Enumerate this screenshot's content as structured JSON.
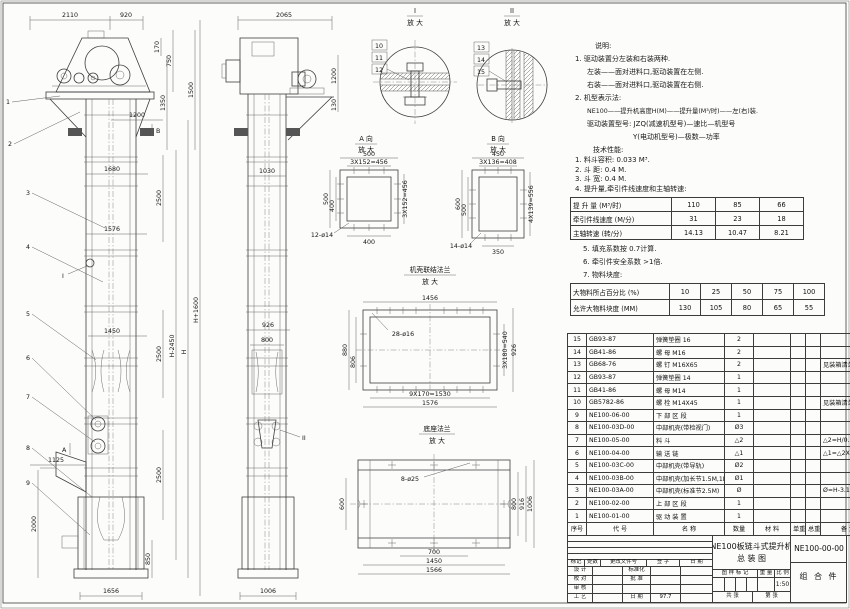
{
  "sheet": {
    "kind": "engineering-drawing"
  },
  "d": {
    "mag": "放 大",
    "front": {
      "t2110": "2110",
      "t920": "920",
      "t170": "170",
      "t750": "750",
      "t1350": "1350",
      "t1500": "1500",
      "t1200": "1200",
      "t1680": "1680",
      "t2500": "2500",
      "t1576": "1576",
      "t1450": "1450",
      "t1125": "1125",
      "t2000": "2000",
      "t850": "850",
      "t1656": "1656",
      "hp": "H+1600",
      "hm": "H-2450",
      "h": "H",
      "secA": "A",
      "secB": "B",
      "detI": "I"
    },
    "side": {
      "t2065": "2065",
      "t1200": "1200",
      "t130": "130",
      "t1030": "1030",
      "t926": "926",
      "t800": "800",
      "t1006": "1006",
      "detII": "II"
    },
    "leaders": [
      "1",
      "2",
      "3",
      "4",
      "5",
      "6",
      "7",
      "8",
      "9",
      "10",
      "11",
      "12",
      "13",
      "14",
      "15"
    ],
    "detailI": {
      "title": "I"
    },
    "detailII": {
      "title": "II"
    },
    "viewA": {
      "title": "A 向",
      "d500": "500",
      "pitch": "3X152=456",
      "d400": "400",
      "holes": "12-ø14"
    },
    "viewB": {
      "title": "B 向",
      "d450": "450",
      "pitch": "3X136=408",
      "d600": "600",
      "d500": "500",
      "rows": "4X139=556",
      "d350": "350",
      "holes": "14-ø14"
    },
    "flange": {
      "title": "机壳联结法兰",
      "d1456": "1456",
      "holes": "28-ø16",
      "d880": "880",
      "d806": "806",
      "rows": "3X180=540",
      "d926": "926",
      "cols": "9X170=1530",
      "d1576": "1576"
    },
    "base": {
      "title": "底座法兰",
      "holes": "8-ø25",
      "d600": "600",
      "d800": "800",
      "d916": "916",
      "d1006": "1006",
      "d700": "700",
      "d1450": "1450",
      "d1566": "1566"
    }
  },
  "notes": {
    "heading": "说明:",
    "lines": [
      "1. 驱动装置分左装和右装两种.",
      "左装——面对进料口,驱动装置在左侧.",
      "右装——面对进料口,驱动装置在右侧.",
      "2. 机型表示法:",
      "NE100——提升机高度H(M)——提升量(M³/时)——左(右)装.",
      "驱动装置型号: JZQ(减速机型号)—速比—机型号",
      "Y(电动机型号)—极数—功率"
    ]
  },
  "tech": {
    "heading": "技术性能:",
    "items_pre": [
      "1. 料斗容积: 0.033 M³.",
      "2. 斗  距: 0.4 M.",
      "3. 斗  宽: 0.4 M.",
      "4. 提升量,牵引件线速度和主轴转速:"
    ],
    "capacity_table": {
      "rows": [
        {
          "label": "提 升 量  (M³/时)",
          "v": [
            "110",
            "85",
            "66"
          ]
        },
        {
          "label": "牵引件线速度 (M/分)",
          "v": [
            "31",
            "23",
            "18"
          ]
        },
        {
          "label": "主轴转速  (转/分)",
          "v": [
            "14.13",
            "10.47",
            "8.21"
          ]
        }
      ]
    },
    "items_post": [
      "5. 填充系数按 0.7计算.",
      "6. 牵引件安全系数 >1倍.",
      "7. 物料块度:"
    ],
    "block_table": {
      "rows": [
        {
          "label": "大物料所占百分比 (%)",
          "v": [
            "10",
            "25",
            "50",
            "75",
            "100"
          ]
        },
        {
          "label": "允许大物料块度 (MM)",
          "v": [
            "130",
            "105",
            "80",
            "65",
            "55"
          ]
        }
      ]
    }
  },
  "bom": {
    "header": {
      "no": "序号",
      "code": "代  号",
      "name": "名  称",
      "qty": "数量",
      "material": "材  料",
      "uw": "单重",
      "tw": "总重",
      "remark": "备 注"
    },
    "rows": [
      {
        "no": "15",
        "code": "GB93-87",
        "name": "弹簧垫圈  16",
        "qty": "2",
        "remark": ""
      },
      {
        "no": "14",
        "code": "GB41-86",
        "name": "螺 母  M16",
        "qty": "2",
        "remark": ""
      },
      {
        "no": "13",
        "code": "GB68-76",
        "name": "螺 钉  M16X65",
        "qty": "2",
        "remark": "见装箱清单"
      },
      {
        "no": "12",
        "code": "GB93-87",
        "name": "弹簧垫圈  14",
        "qty": "1",
        "remark": ""
      },
      {
        "no": "11",
        "code": "GB41-86",
        "name": "螺 母  M14",
        "qty": "1",
        "remark": ""
      },
      {
        "no": "10",
        "code": "GB5782-86",
        "name": "螺 栓  M14X45",
        "qty": "1",
        "remark": "见装箱清单"
      },
      {
        "no": "9",
        "code": "NE100-06-00",
        "name": "下 部 区 段",
        "qty": "1",
        "remark": ""
      },
      {
        "no": "8",
        "code": "NE100-03D-00",
        "name": "中部机壳(带检视门)",
        "qty": "Ø3",
        "remark": ""
      },
      {
        "no": "7",
        "code": "NE100-05-00",
        "name": "料 斗",
        "qty": "△2",
        "remark": "△2=H/0.2+5.75"
      },
      {
        "no": "6",
        "code": "NE100-04-00",
        "name": "输 送 链",
        "qty": "△1",
        "remark": "△1=△2X4"
      },
      {
        "no": "5",
        "code": "NE100-03C-00",
        "name": "中部机壳(带导轨)",
        "qty": "Ø2",
        "remark": ""
      },
      {
        "no": "4",
        "code": "NE100-03B-00",
        "name": "中部机壳(加长节1.5M,1M)",
        "qty": "Ø1",
        "remark": ""
      },
      {
        "no": "3",
        "code": "NE100-03A-00",
        "name": "中部机壳(标准节2.5M)",
        "qty": "Ø",
        "remark": "Ø=H-3.15/2.5"
      },
      {
        "no": "2",
        "code": "NE100-02-00",
        "name": "上 部 区 段",
        "qty": "1",
        "remark": ""
      },
      {
        "no": "1",
        "code": "NE100-01-00",
        "name": "驱 动 装 置",
        "qty": "1",
        "remark": ""
      }
    ]
  },
  "titleblock": {
    "rev_header": [
      "标记",
      "处数",
      "更改文件号",
      "签 字",
      "日 期"
    ],
    "sign_rows": [
      [
        "设 计",
        "标准化"
      ],
      [
        "校 对",
        "批 准"
      ],
      [
        "审 核",
        ""
      ],
      [
        "工 艺",
        "日 期"
      ]
    ],
    "date": "97.7",
    "title_line1": "NE100板链斗式提升机",
    "title_line2": "总  装  图",
    "stamp_header": [
      "图 样 标 记",
      "重 量",
      "比 例"
    ],
    "scale": "1:50",
    "sheet_cells": [
      "共  张",
      "第  张"
    ],
    "drawing_no": "NE100-00-00",
    "part_type": "组 合 件"
  }
}
